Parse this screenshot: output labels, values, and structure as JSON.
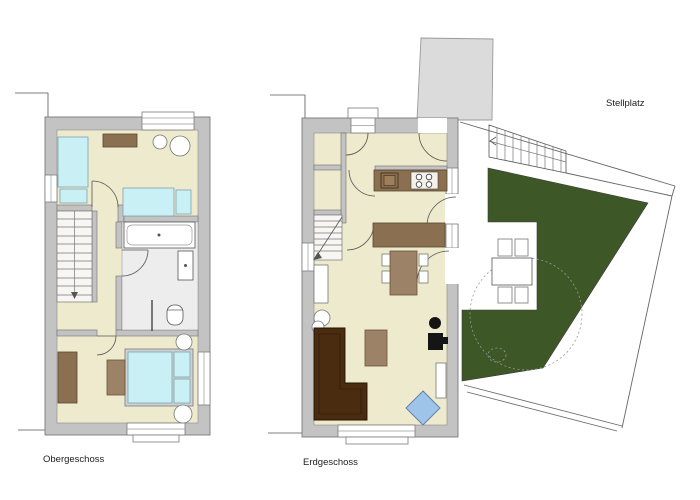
{
  "labels": {
    "obergeschoss": "Obergeschoss",
    "erdgeschoss": "Erdgeschoss",
    "stellplatz": "Stellplatz"
  },
  "colors": {
    "floor": "#EDEACD",
    "wall": "#C3C3C3",
    "bath_floor": "#EDEDED",
    "water_blue": "#C9F0F5",
    "furniture_brown": "#8A7051",
    "furniture_brown_light": "#9C8266",
    "sofa_brown": "#4A2C10",
    "garden_green": "#3E5727",
    "armchair_blue": "#9FC4EA"
  },
  "floors": [
    {
      "name": "Obergeschoss",
      "rooms": [
        "bedroom-top",
        "bathroom",
        "bedroom-bottom",
        "stairs",
        "hall"
      ],
      "furniture": [
        "single-bed",
        "single-bed",
        "dresser",
        "round-table",
        "bathtub",
        "wash-basin",
        "toilet",
        "double-bed",
        "wardrobe",
        "side-table",
        "nightstand",
        "nightstand"
      ]
    },
    {
      "name": "Erdgeschoss",
      "rooms": [
        "entry-hall",
        "storage",
        "wc",
        "stairs",
        "kitchen",
        "living-dining"
      ],
      "furniture": [
        "kitchen-counter",
        "cooktop",
        "kitchen-sink",
        "sideboard",
        "dining-table",
        "dining-chairs",
        "sofa",
        "coffee-table",
        "wood-stove",
        "armchair",
        "shelf",
        "radiator"
      ]
    }
  ],
  "outdoor": {
    "name": "Stellplatz",
    "features": [
      "parking-area",
      "garden",
      "terrace",
      "garden-table",
      "garden-chairs",
      "tree",
      "exterior-stairs",
      "neighbor-building"
    ]
  }
}
